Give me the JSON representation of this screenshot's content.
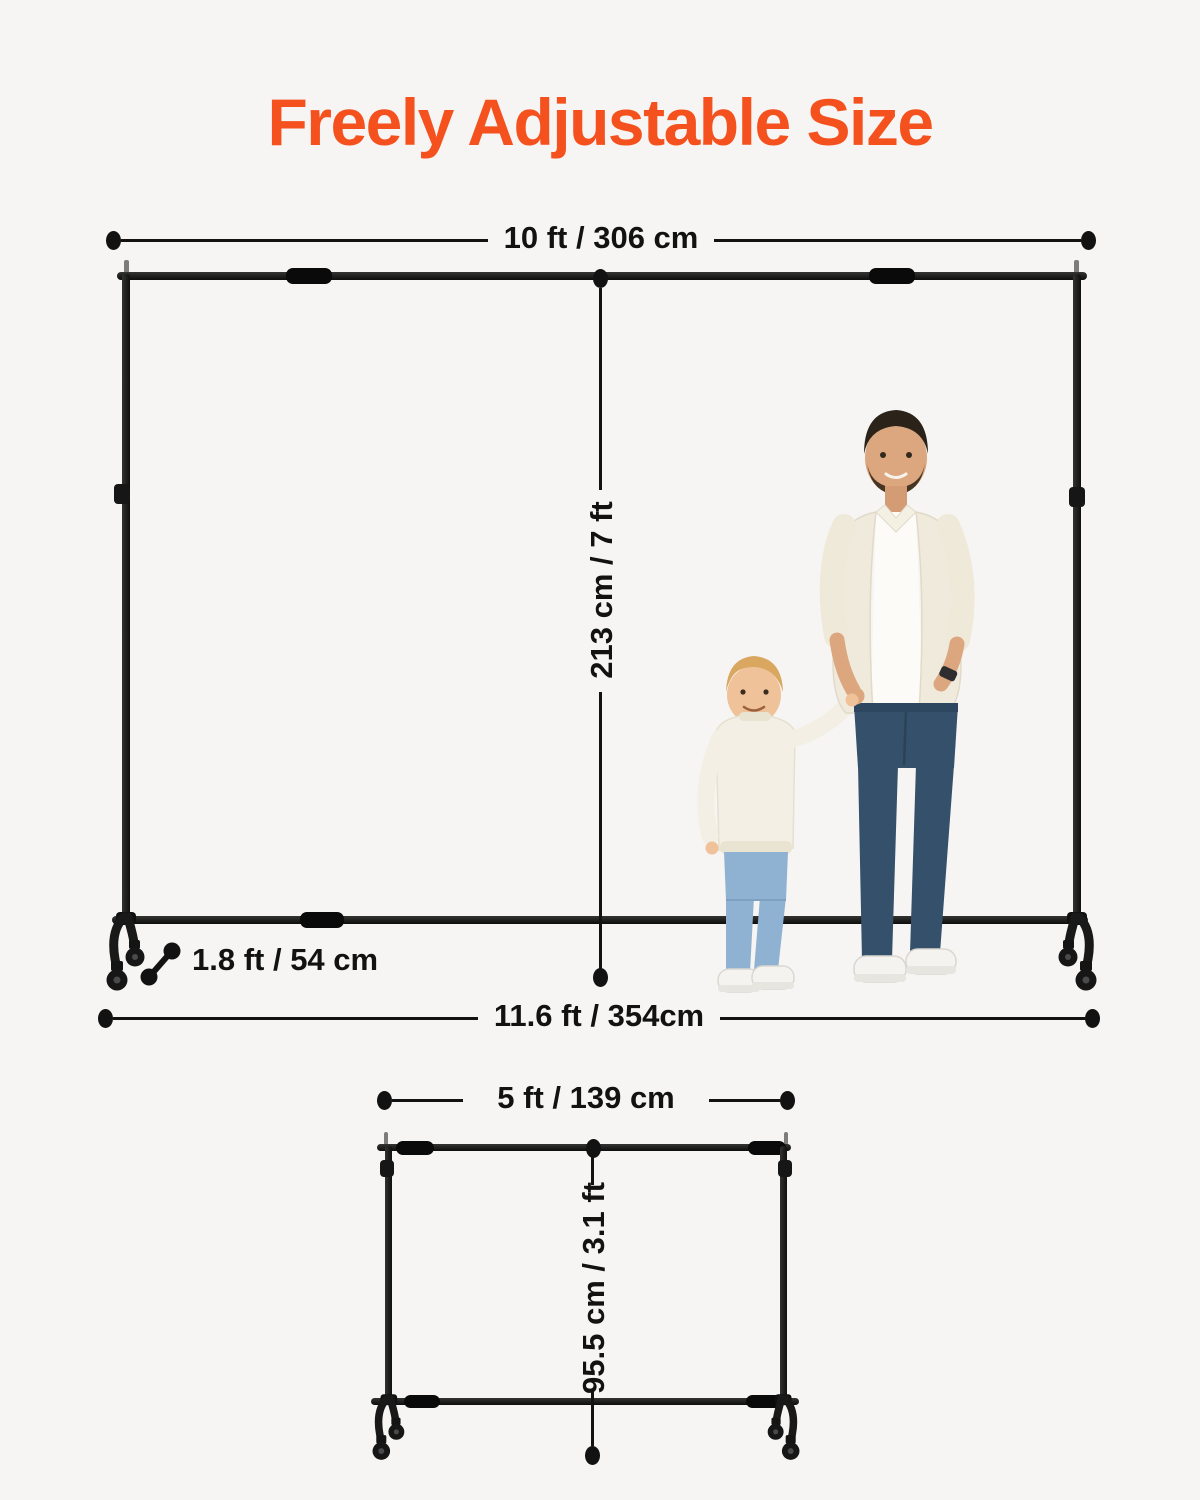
{
  "colors": {
    "background": "#f6f5f3",
    "accent_orange": "#f4511e",
    "line_ink": "#121212",
    "frame_black": "#141414",
    "man_jeans_blue": "#35506b",
    "child_jeans_blue": "#8fb2d2",
    "shirt_cream": "#f0eadc"
  },
  "title": "Freely Adjustable Size",
  "large_stand": {
    "top_width_label": "10 ft / 306 cm",
    "height_label": "213 cm / 7 ft",
    "base_depth_label": "1.8 ft / 54 cm",
    "bottom_width_label": "11.6 ft / 354cm"
  },
  "small_stand": {
    "top_width_label": "5 ft / 139 cm",
    "height_label": "95.5 cm / 3.1 ft"
  }
}
